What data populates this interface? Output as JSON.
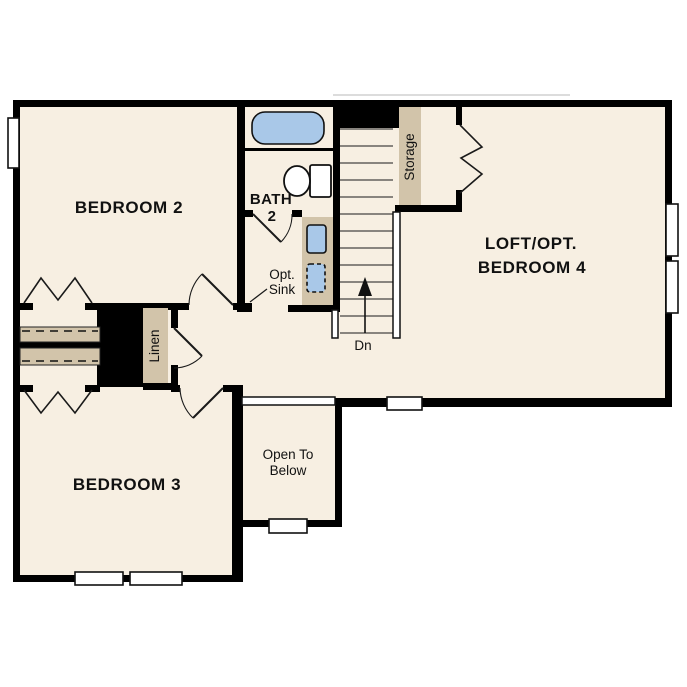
{
  "title": "Second Floor Plan",
  "colors": {
    "floor": "#f7efe2",
    "wall": "#000000",
    "fixture_blue": "#a9c8e8",
    "cabinet_tan": "#d2c4aa",
    "background": "#ffffff"
  },
  "rooms": {
    "bedroom2": {
      "label": "BEDROOM 2"
    },
    "bedroom3": {
      "label": "BEDROOM 3"
    },
    "loft": {
      "label_line1": "LOFT/OPT.",
      "label_line2": "BEDROOM 4"
    },
    "bath": {
      "label_line1": "BATH",
      "label_line2": "2"
    },
    "open_below": {
      "label_line1": "Open To",
      "label_line2": "Below"
    }
  },
  "annotations": {
    "opt_sink_line1": "Opt.",
    "opt_sink_line2": "Sink",
    "stairs_direction": "Dn",
    "linen_closet": "Linen",
    "storage_closet": "Storage"
  }
}
